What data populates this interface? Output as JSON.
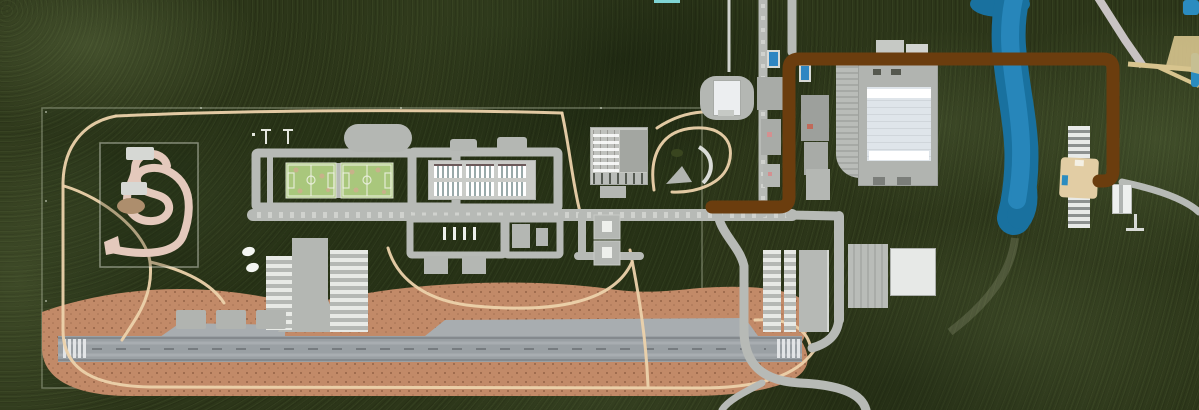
{
  "meta": {
    "width": 1199,
    "height": 410,
    "view": "aerial-satellite"
  },
  "scene": {
    "type": "satellite-map-with-route-annotation",
    "features": [
      {
        "name": "forest-terrain"
      },
      {
        "name": "facility-boundary-fence"
      },
      {
        "name": "go-kart-track"
      },
      {
        "name": "walking-paths"
      },
      {
        "name": "football-fields",
        "count": 2
      },
      {
        "name": "oval-building"
      },
      {
        "name": "barracks-building",
        "window_blocks": 6
      },
      {
        "name": "grid-roof-building"
      },
      {
        "name": "baseball-field"
      },
      {
        "name": "pavilion-building"
      },
      {
        "name": "service-buildings-cluster"
      },
      {
        "name": "swimming-pools",
        "count": 2
      },
      {
        "name": "stadium"
      },
      {
        "name": "stadium-parking-rows"
      },
      {
        "name": "warehouse-buildings"
      },
      {
        "name": "airport-runway"
      },
      {
        "name": "runway-thresholds",
        "count": 2
      },
      {
        "name": "airport-apron"
      },
      {
        "name": "taxiways"
      },
      {
        "name": "terminal-buildings"
      },
      {
        "name": "aircraft",
        "count": 2
      },
      {
        "name": "parking-pads",
        "count": 3
      },
      {
        "name": "utility-pads",
        "count": 2
      },
      {
        "name": "river"
      },
      {
        "name": "dock-pier"
      },
      {
        "name": "dock-building"
      },
      {
        "name": "riverside-road"
      },
      {
        "name": "route-annotation"
      }
    ]
  },
  "route": {
    "color": "#6b3d0e",
    "stroke_width": 13,
    "points": [
      [
        712,
        207
      ],
      [
        789,
        207
      ],
      [
        789,
        59
      ],
      [
        1113,
        59
      ],
      [
        1113,
        181
      ],
      [
        1099,
        181
      ]
    ]
  },
  "colors": {
    "forest_base": "#2c3619",
    "path_tan": "#ecd2ab",
    "road_gray": "#b7bab6",
    "road_dash": "#d8dad5",
    "runway_gray": "#9aa0a4",
    "runway_stripe": "#a8adb1",
    "runway_edge": "#84898d",
    "threshold_white": "#e8eaec",
    "apron_brown": "#c28a68",
    "apron_dot": "#8a5a3e",
    "taxiway_gray": "#a8adb0",
    "field_green": "#a9c77c",
    "field_line": "#eef2e4",
    "track_pink": "#e4c9bc",
    "kart_oval": "#ad8e6d",
    "building_gray": "#b4b7b3",
    "building_mid": "#a8aba7",
    "building_dark": "#9da09c",
    "building_white": "#eceef0",
    "stripe_light": "#e8eae6",
    "water_blue": "#19719f",
    "water_light": "#2b8cc0",
    "route_brown": "#6b3d0e",
    "yellow_road": "#d7c48e",
    "pink_accent": "#d49090",
    "red_accent": "#c06a5a",
    "cyan_strip": "#7fd4d4",
    "pier_tan": "#e2cda4"
  }
}
